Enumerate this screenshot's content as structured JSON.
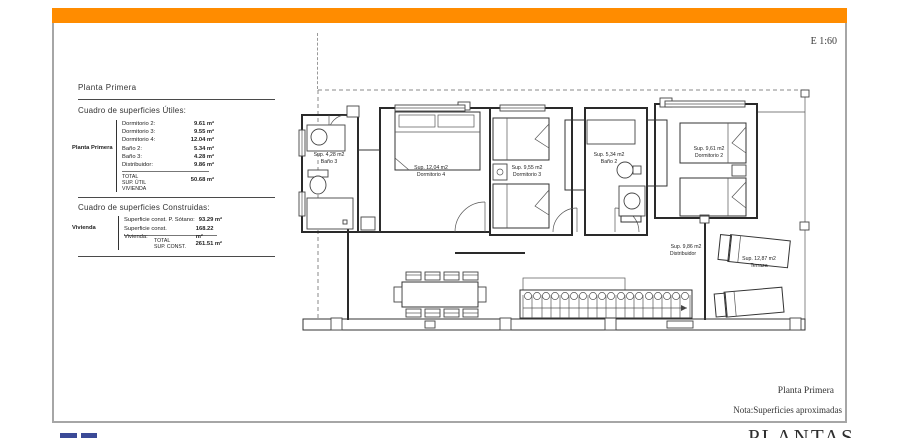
{
  "scale_label": "E 1:60",
  "sidebar": {
    "title": "Planta Primera",
    "useful_table": {
      "title": "Cuadro de superficies Útiles:",
      "group_label": "Planta Primera",
      "rows": [
        {
          "label": "Dormitorio 2:",
          "value": "9.61 m²"
        },
        {
          "label": "Dormitorio 3:",
          "value": "9.55 m²"
        },
        {
          "label": "Dormitorio 4:",
          "value": "12.04 m²"
        },
        {
          "label": "Baño 2:",
          "value": "5.34 m²"
        },
        {
          "label": "Baño 3:",
          "value": "4.28 m²"
        },
        {
          "label": "Distribuidor:",
          "value": "9.86 m²"
        }
      ],
      "total_label": "TOTAL\nSUP. ÚTIL\nVIVIENDA",
      "total_value": "50.68 m²"
    },
    "built_table": {
      "title": "Cuadro de superficies Construidas:",
      "group_label": "Vivienda",
      "rows": [
        {
          "label": "Superficie const. P. Sótano:",
          "value": "93.29 m²"
        },
        {
          "label": "Superficie const. Vivienda:",
          "value": "168.22 m²"
        }
      ],
      "total_label": "TOTAL\nSUP. CONST.",
      "total_value": "261.51 m²"
    }
  },
  "plan": {
    "rooms": {
      "bano3": {
        "sup": "Sup. 4,28 m2",
        "name": "Baño 3"
      },
      "dorm4": {
        "sup": "Sup. 12,04 m2",
        "name": "Dormitorio 4"
      },
      "dorm3": {
        "sup": "Sup. 9,55 m2",
        "name": "Dormitorio 3"
      },
      "bano2": {
        "sup": "Sup. 5,34 m2",
        "name": "Baño 2"
      },
      "dorm2": {
        "sup": "Sup. 9,61 m2",
        "name": "Dormitorio 2"
      },
      "distribuidor": {
        "sup": "Sup. 9,86 m2",
        "name": "Distribuidor"
      },
      "terraza": {
        "sup": "Sup. 12,87 m2",
        "name": "Terraza"
      }
    }
  },
  "footer": {
    "plan_name": "Planta Primera",
    "note": "Nota:Superficies aproximadas",
    "big_title": "PLANTAS"
  },
  "colors": {
    "accent_orange": "#FF8C00",
    "logo_blue": "#3B4A97",
    "frame_gray": "#A6A6A6"
  }
}
